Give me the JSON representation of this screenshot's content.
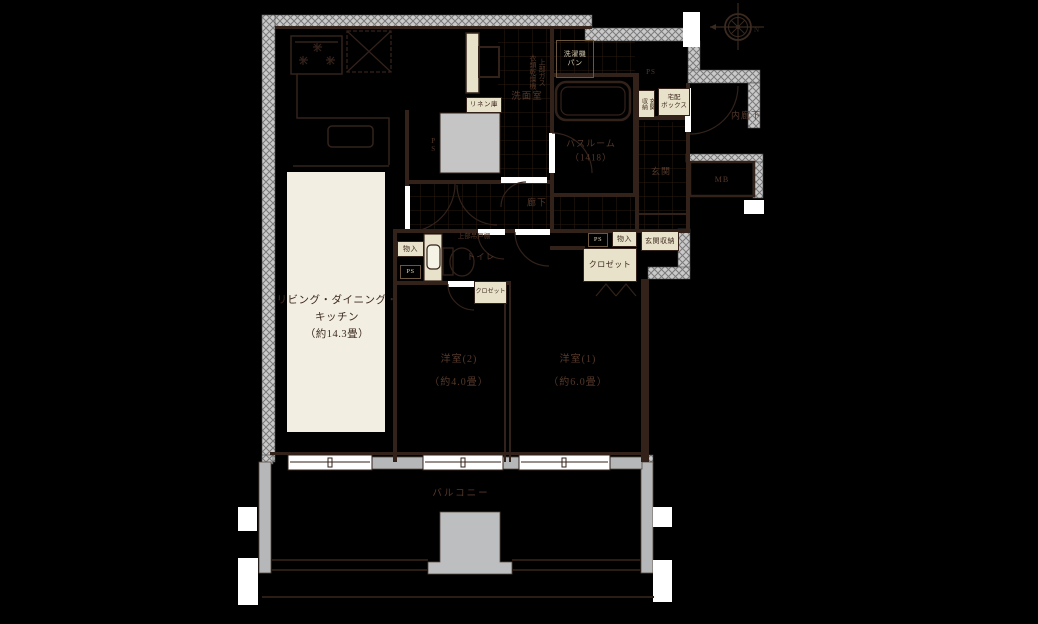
{
  "floorplan": {
    "rooms": {
      "ldk": {
        "label": "リビング・ダイニング・\nキッチン\n（約14.3畳）"
      },
      "bedroom2": {
        "label": "洋室(2)\n（約4.0畳）"
      },
      "bedroom1": {
        "label": "洋室(1)\n（約6.0畳）"
      },
      "balcony": {
        "label": "バルコニー"
      },
      "washroom": {
        "label": "洗面室"
      },
      "hallway": {
        "label": "廊下"
      },
      "entrance": {
        "label": "玄関"
      },
      "inner_corridor": {
        "label": "内廊下"
      },
      "bathroom": {
        "label": "バスルーム\n（1418）"
      },
      "toilet": {
        "label": "トイレ"
      }
    },
    "fixtures": {
      "linen": "リネン庫",
      "washer_pan": "洗濯機\nパン",
      "gas_dryer": "上部ガス\n衣類乾燥機",
      "upper_cabinet": "上部吊戸棚",
      "storage_left": "物入",
      "storage_right": "物入",
      "closet_bedroom1": "クロゼット",
      "closet_bedroom2": "クロゼット",
      "entrance_storage_top": "玄関\n収納",
      "entrance_storage_right": "玄関収納",
      "delivery_box": "宅配\nボックス",
      "meter_box": "MB",
      "ps_top": "PS",
      "ps_left": "PS",
      "ps_mid": "PS",
      "ps_right": "PS"
    },
    "compass": {
      "north_label": "N"
    },
    "colors": {
      "background": "#000000",
      "line": "#33221a",
      "room_fill": "#f2eee1",
      "label_box_fill": "#e9e2ca",
      "label_text_dark": "#3d2a1f",
      "label_text_on_dark": "#56392a",
      "tan_text": "#d8cdb2",
      "wall_hatch": "#c9c9c9",
      "gray_block": "#c5c5c6",
      "balcony_wall": "#b5b7b9"
    }
  }
}
